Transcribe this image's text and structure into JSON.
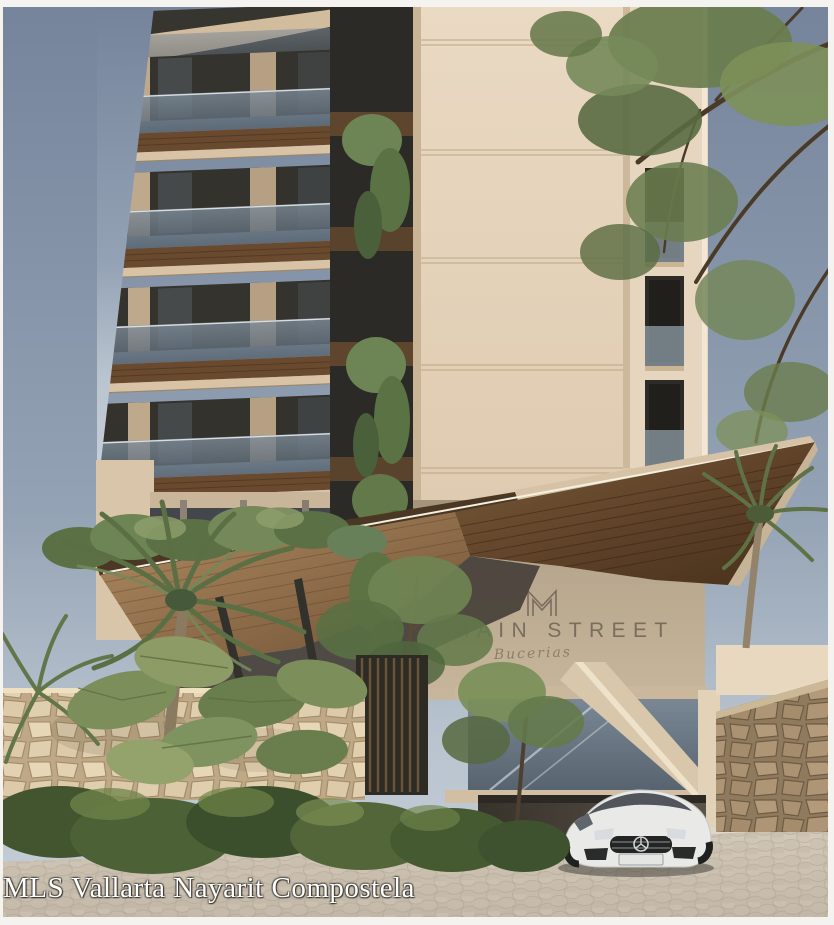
{
  "image": {
    "kind": "architectural-rendering-photo",
    "subject": "Modern beige condo tower with angular wood entrance canopy, tropical landscaping, white sports car at porte-cochere, cobblestone street"
  },
  "watermark": {
    "text": "MLS Vallarta Nayarit Compostela",
    "color": "#ffffff"
  },
  "sign": {
    "logo_mark": "M-monogram",
    "title": "MAIN STREET",
    "subtitle": "Bucerias",
    "title_color": "#6e6255"
  },
  "scene": {
    "objects": [
      "left-balcony-tower",
      "central-stucco-core",
      "right-window-tower",
      "overhanging-tree",
      "angular-wood-canopy",
      "roof-garden-plants",
      "hanging-vines",
      "entrance-sign-wall",
      "glass-curtain-wall",
      "diagonal-entry-wall",
      "carport-opening",
      "white-sports-car",
      "flagstone-wall-right",
      "flagstone-wall-left",
      "wood-slat-gate",
      "palm-tree-left",
      "palm-tree-right",
      "tropical-shrubs",
      "big-leaf-plants",
      "cobblestone-street"
    ],
    "palette": {
      "sky_top": "#75849b",
      "sky_low": "#b9c4cf",
      "facade_light": "#e8d8c2",
      "facade_shadow": "#b5a58c",
      "canopy_wood_dark": "#4e3520",
      "canopy_wood_light": "#a8815a",
      "glass": "#5e6b77",
      "stone_right": "#9b8568",
      "stone_left": "#dcc9a8",
      "street": "#cbc0b0",
      "car": "#e9eae7",
      "foliage": "#5a7044",
      "frame_white": "#f5f3ef"
    }
  }
}
